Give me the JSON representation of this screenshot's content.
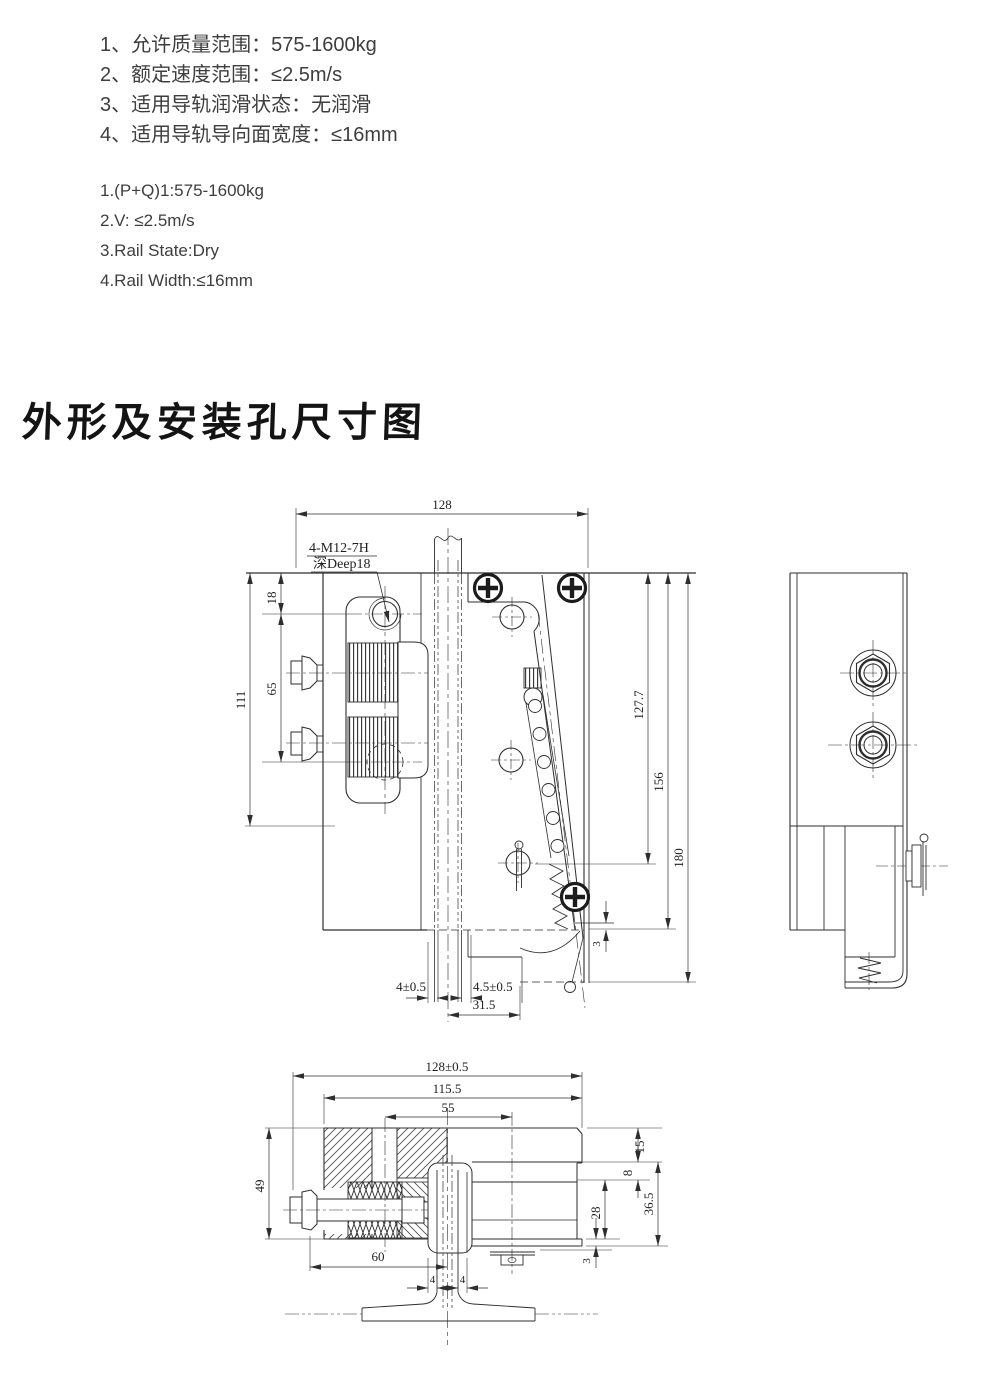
{
  "page": {
    "background": "#ffffff",
    "ink": "#2e2e2e",
    "text_color": "#3e3e3e"
  },
  "specs_zh": {
    "items": [
      "1、允许质量范围：575-1600kg",
      "2、额定速度范围：≤2.5m/s",
      "3、适用导轨润滑状态：无润滑",
      "4、适用导轨导向面宽度：≤16mm"
    ]
  },
  "specs_en": {
    "items": [
      "1.(P+Q)1:575-1600kg",
      "2.V: ≤2.5m/s",
      "3.Rail State:Dry",
      "4.Rail Width:≤16mm"
    ]
  },
  "heading": {
    "title": "外形及安装孔尺寸图"
  },
  "front_view": {
    "hole_note_line1": "4-M12-7H",
    "hole_note_line2": "深Deep18",
    "dim_width": "128",
    "dim_top_hole": "18",
    "dim_hole_spacing": "65",
    "dim_plate_height": "111",
    "dim_pin_height": "127.7",
    "dim_body_height": "156",
    "dim_total_height": "180",
    "dim_gap_left": "4±0.5",
    "dim_gap_right": "4.5±0.5",
    "dim_offset": "31.5",
    "dim_step": "3"
  },
  "bottom_view": {
    "dim_width_total": "128±0.5",
    "dim_width_inner": "115.5",
    "dim_bolt_offset": "55",
    "dim_height": "49",
    "dim_bolt_length": "60",
    "dim_top": "15",
    "dim_step": "8",
    "dim_lower": "28",
    "dim_lower_total": "36.5",
    "dim_plate": "3",
    "dim_web_left": "4",
    "dim_web_right": "4"
  }
}
